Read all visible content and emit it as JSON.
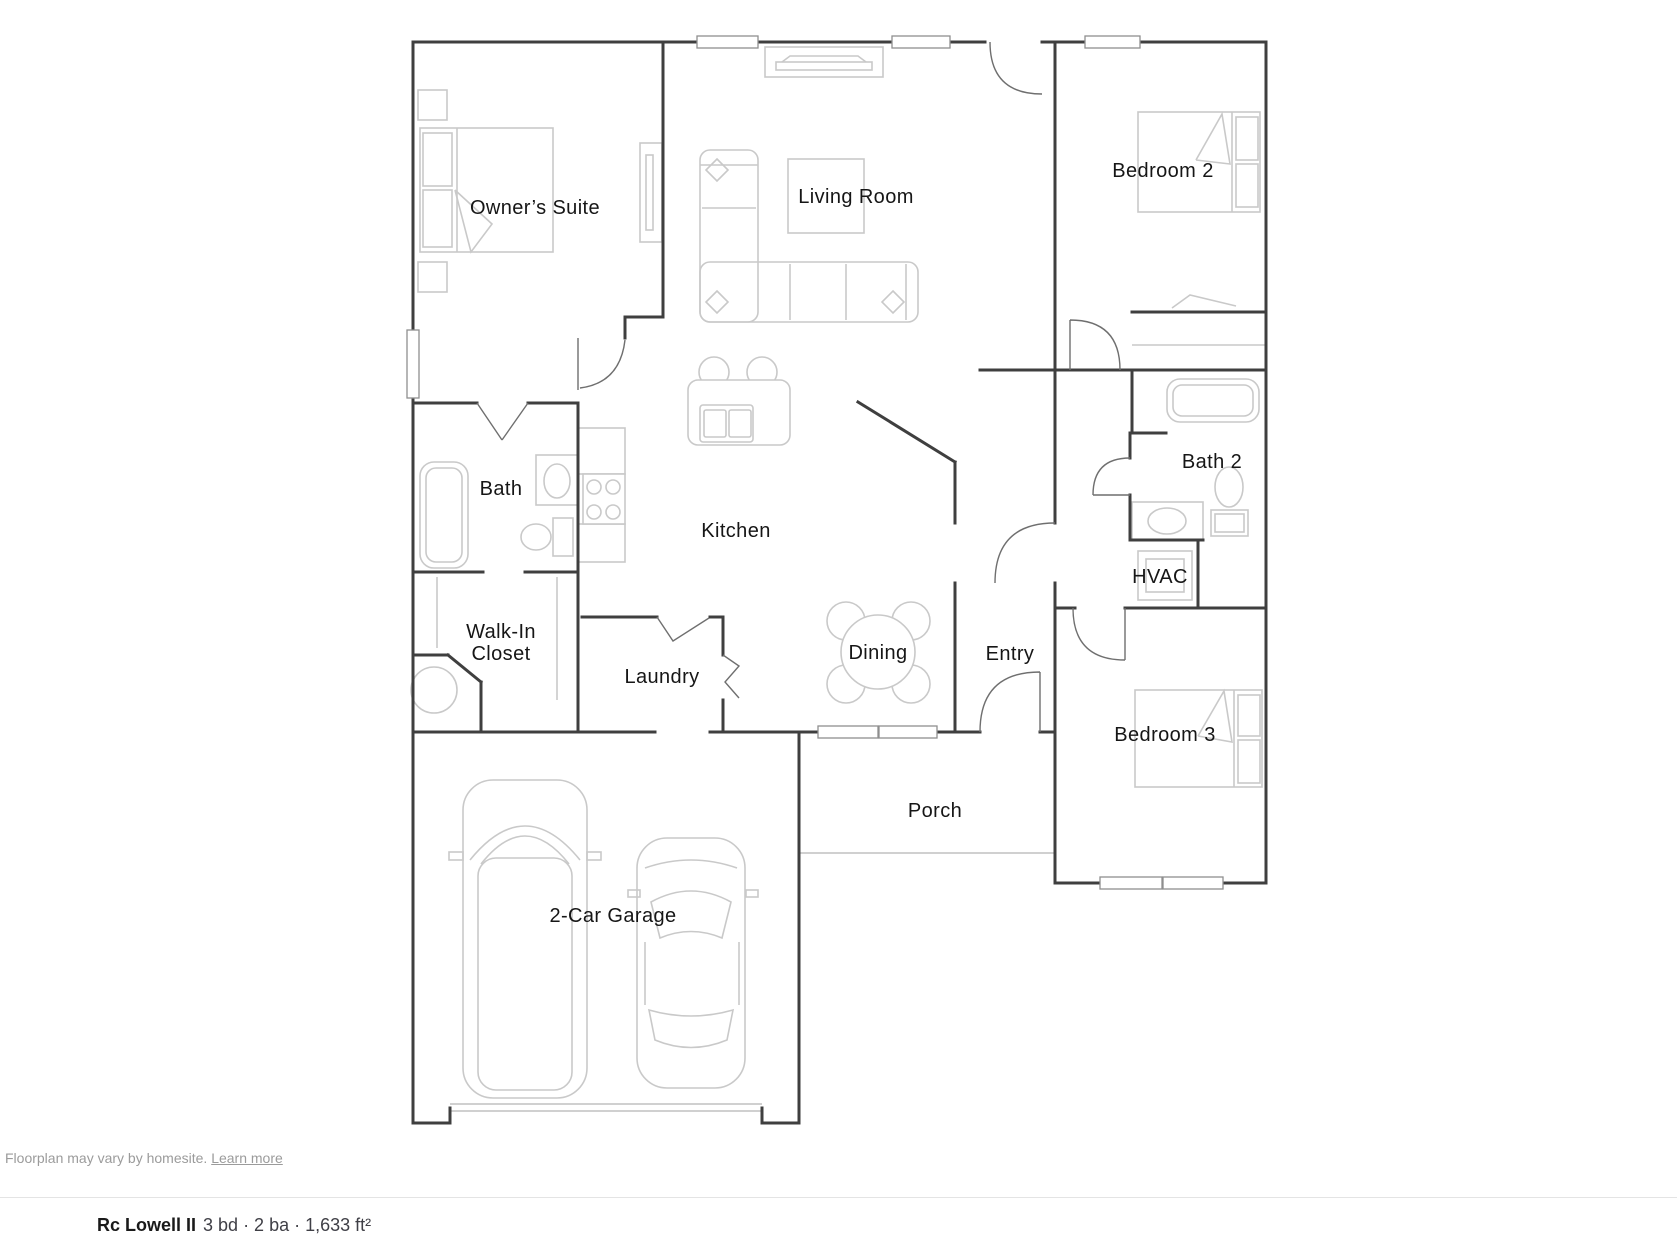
{
  "colors": {
    "wall": "#3f3f3f",
    "door": "#6f6f6f",
    "furniture": "#c9c9c9",
    "label": "#161616",
    "footer_text": "#9b9b9b",
    "divider": "#e4e4e4",
    "title": "#1a1a1a",
    "subtitle": "#3f3f46",
    "window_frame": "#8f8f8f"
  },
  "plan": {
    "rooms": {
      "owners_suite": "Owner’s Suite",
      "living_room": "Living Room",
      "bedroom2": "Bedroom 2",
      "bath": "Bath",
      "kitchen": "Kitchen",
      "bath2": "Bath 2",
      "hvac": "HVAC",
      "walk_in_line1": "Walk-In",
      "walk_in_line2": "Closet",
      "laundry": "Laundry",
      "dining": "Dining",
      "entry": "Entry",
      "bedroom3": "Bedroom 3",
      "porch": "Porch",
      "garage": "2-Car Garage"
    }
  },
  "footer": {
    "disclaimer": "Floorplan may vary by homesite.",
    "link": "Learn more"
  },
  "summary": {
    "plan_name": "Rc Lowell II",
    "details": "3 bd · 2 ba · 1,633 ft²"
  }
}
